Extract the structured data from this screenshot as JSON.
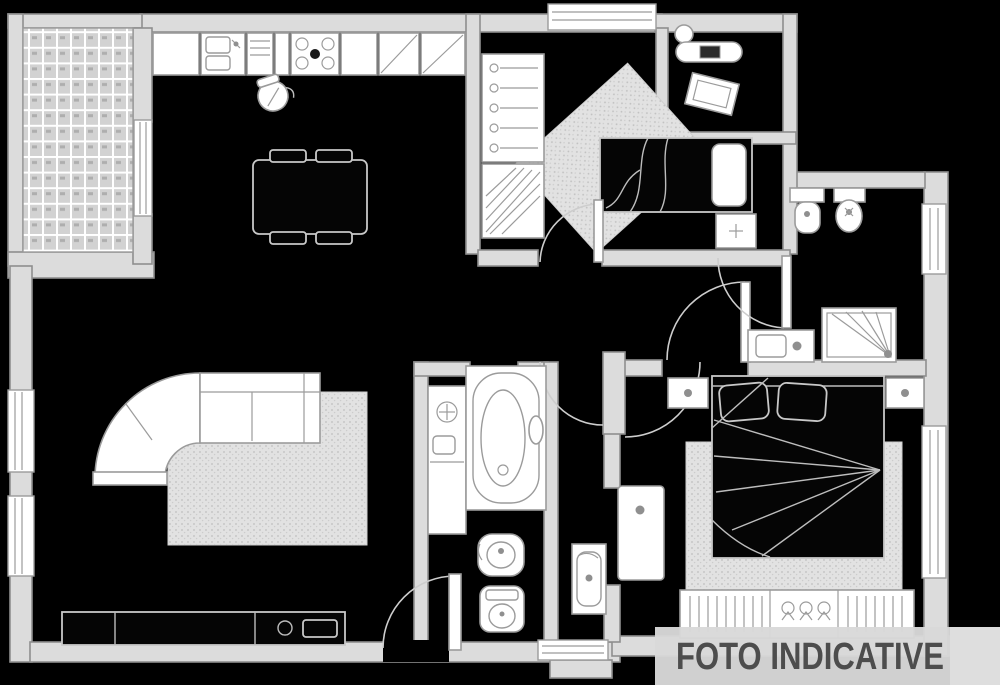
{
  "banner": {
    "text": "FOTO INDICATIVE",
    "bg": "#d8d8d8",
    "text_color": "#4d4d4d"
  },
  "plan": {
    "background": "#000000",
    "wall_fill": "#dcdcdc",
    "wall_stroke": "#8e8e8e",
    "fixture_fill": "#ffffff",
    "outline_color": "#c8c8c8",
    "rug_fill": "#e2e2e2",
    "rooms": [
      {
        "name": "terrace",
        "feature": "tiled-floor-grid"
      },
      {
        "name": "kitchen-living-room",
        "features": [
          "kitchen-counter",
          "sink",
          "stove",
          "dining-table",
          "corner-sofa",
          "rug",
          "sideboard",
          "entrance-door"
        ]
      },
      {
        "name": "bedroom-2",
        "features": [
          "wardrobe-hangers",
          "shelf-unit",
          "single-bed",
          "nightstand",
          "diagonal-rug",
          "top-window"
        ]
      },
      {
        "name": "laundry-closet",
        "features": [
          "ironing-board",
          "laundry-basket"
        ]
      },
      {
        "name": "hallway",
        "features": [
          "double-door-arcs"
        ]
      },
      {
        "name": "main-bathroom",
        "features": [
          "washbasin",
          "bathtub",
          "bidet",
          "toilet"
        ]
      },
      {
        "name": "corridor",
        "features": [
          "small-sink",
          "door-panel",
          "bottom-window"
        ]
      },
      {
        "name": "bathroom-2",
        "features": [
          "toilet",
          "bidet",
          "vanity",
          "shower",
          "side-window"
        ]
      },
      {
        "name": "master-bedroom",
        "features": [
          "double-bed",
          "pillows",
          "nightstands",
          "rug",
          "wardrobe",
          "side-window"
        ]
      }
    ]
  }
}
